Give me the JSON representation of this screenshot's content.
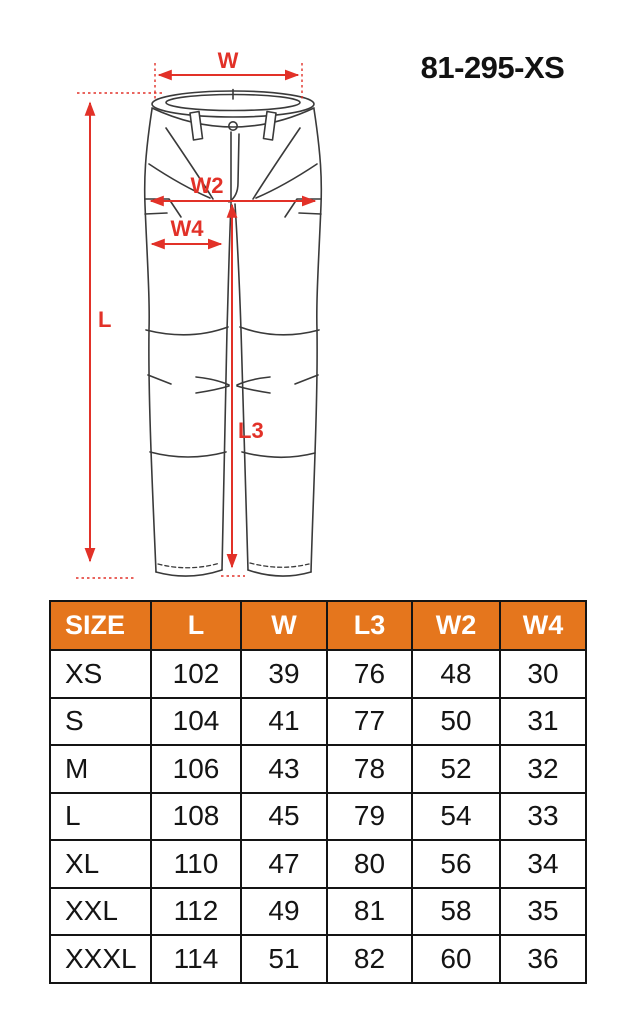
{
  "title": "81-295-XS",
  "diagram": {
    "labels": {
      "w": "W",
      "w2": "W2",
      "w4": "W4",
      "l": "L",
      "l3": "L3"
    },
    "line_color": "#3a3a3a",
    "annotation_color": "#e23128"
  },
  "size_table": {
    "header_bg": "#e5761d",
    "border_color": "#141414",
    "headers": [
      "SIZE",
      "L",
      "W",
      "L3",
      "W2",
      "W4"
    ],
    "rows": [
      {
        "size": "XS",
        "values": [
          102,
          39,
          76,
          48,
          30
        ]
      },
      {
        "size": "S",
        "values": [
          104,
          41,
          77,
          50,
          31
        ]
      },
      {
        "size": "M",
        "values": [
          106,
          43,
          78,
          52,
          32
        ]
      },
      {
        "size": "L",
        "values": [
          108,
          45,
          79,
          54,
          33
        ]
      },
      {
        "size": "XL",
        "values": [
          110,
          47,
          80,
          56,
          34
        ]
      },
      {
        "size": "XXL",
        "values": [
          112,
          49,
          81,
          58,
          35
        ]
      },
      {
        "size": "XXXL",
        "values": [
          114,
          51,
          82,
          60,
          36
        ]
      }
    ]
  }
}
